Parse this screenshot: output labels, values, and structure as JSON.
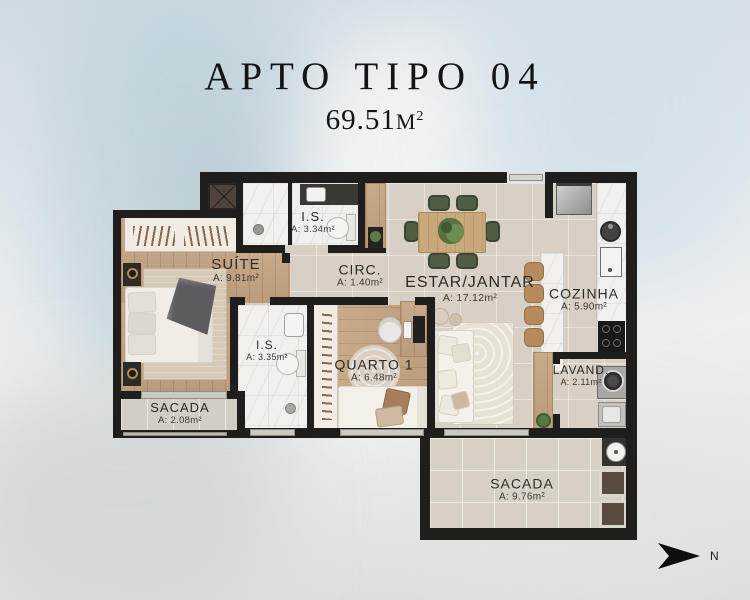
{
  "title": "APTO TIPO 04",
  "area": {
    "value": "69.51",
    "unit": "M",
    "sup": "2"
  },
  "compass": {
    "label": "N"
  },
  "rooms": {
    "suite": {
      "name": "SUÍTE",
      "area": "A: 9.81m²"
    },
    "is1": {
      "name": "I.S.",
      "area": "A: 3.34m²"
    },
    "circ": {
      "name": "CIRC.",
      "area": "A: 1.40m²"
    },
    "estar": {
      "name": "ESTAR/JANTAR",
      "area": "A: 17.12m²"
    },
    "cozinha": {
      "name": "COZINHA",
      "area": "A: 5.90m²"
    },
    "is2": {
      "name": "I.S.",
      "area": "A: 3.35m²"
    },
    "quarto1": {
      "name": "QUARTO 1",
      "area": "A: 6.48m²"
    },
    "lavand": {
      "name": "LAVAND.",
      "area": "A: 2.11m²"
    },
    "sacada1": {
      "name": "SACADA",
      "area": "A: 2.08m²"
    },
    "sacada2": {
      "name": "SACADA",
      "area": "A: 9.76m²"
    }
  },
  "palette": {
    "wall": "#1f1e1c",
    "wood": "#c4a482",
    "tile": "#d8d0c4",
    "marble": "#f2f0ec",
    "chair_green": "#515e45",
    "background": "#dfe6ea"
  }
}
